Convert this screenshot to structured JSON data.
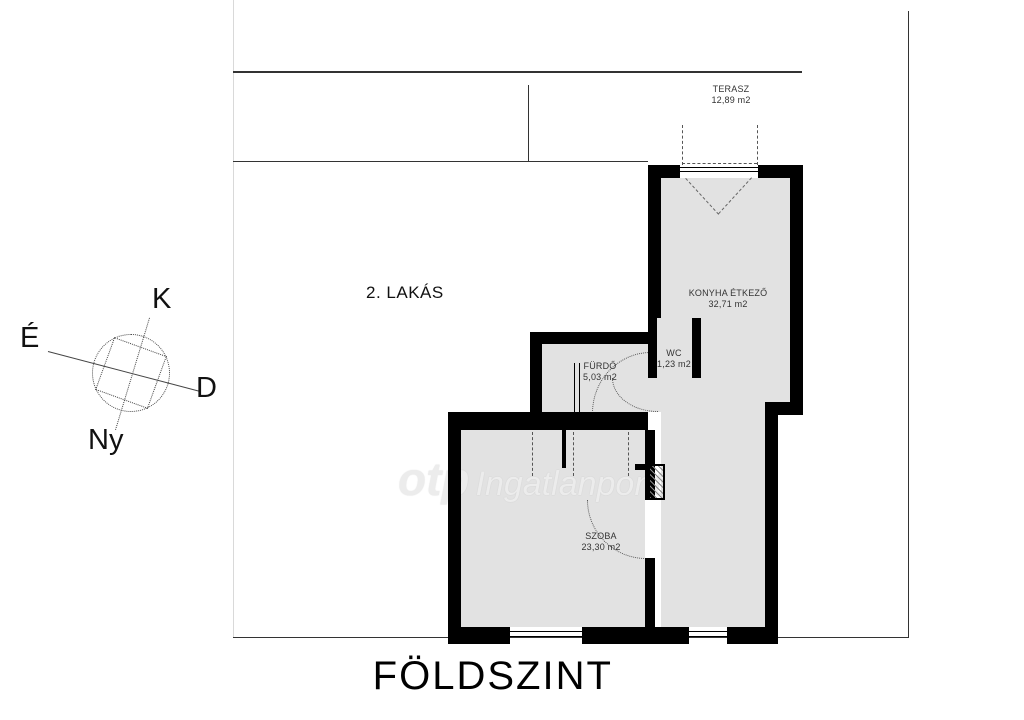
{
  "title": "FÖLDSZINT",
  "apartment_label": "2. LAKÁS",
  "compass": {
    "north": "É",
    "east": "K",
    "south": "D",
    "west": "Ny"
  },
  "watermark": {
    "brand": "otp",
    "name": "Ingatlanpont"
  },
  "rooms": [
    {
      "key": "terasz",
      "name": "TERASZ",
      "area": "12,89 m2"
    },
    {
      "key": "konyha-etkezo",
      "name": "KONYHA ÉTKEZŐ",
      "area": "32,71 m2"
    },
    {
      "key": "wc",
      "name": "WC",
      "area": "1,23 m2"
    },
    {
      "key": "furdo",
      "name": "FÜRDŐ",
      "area": "5,03 m2"
    },
    {
      "key": "szoba",
      "name": "SZOBA",
      "area": "23,30 m2"
    }
  ],
  "colors": {
    "wall": "#000000",
    "room_fill": "#e2e2e2",
    "boundary_line": "#333333",
    "watermark": "#ececec"
  }
}
